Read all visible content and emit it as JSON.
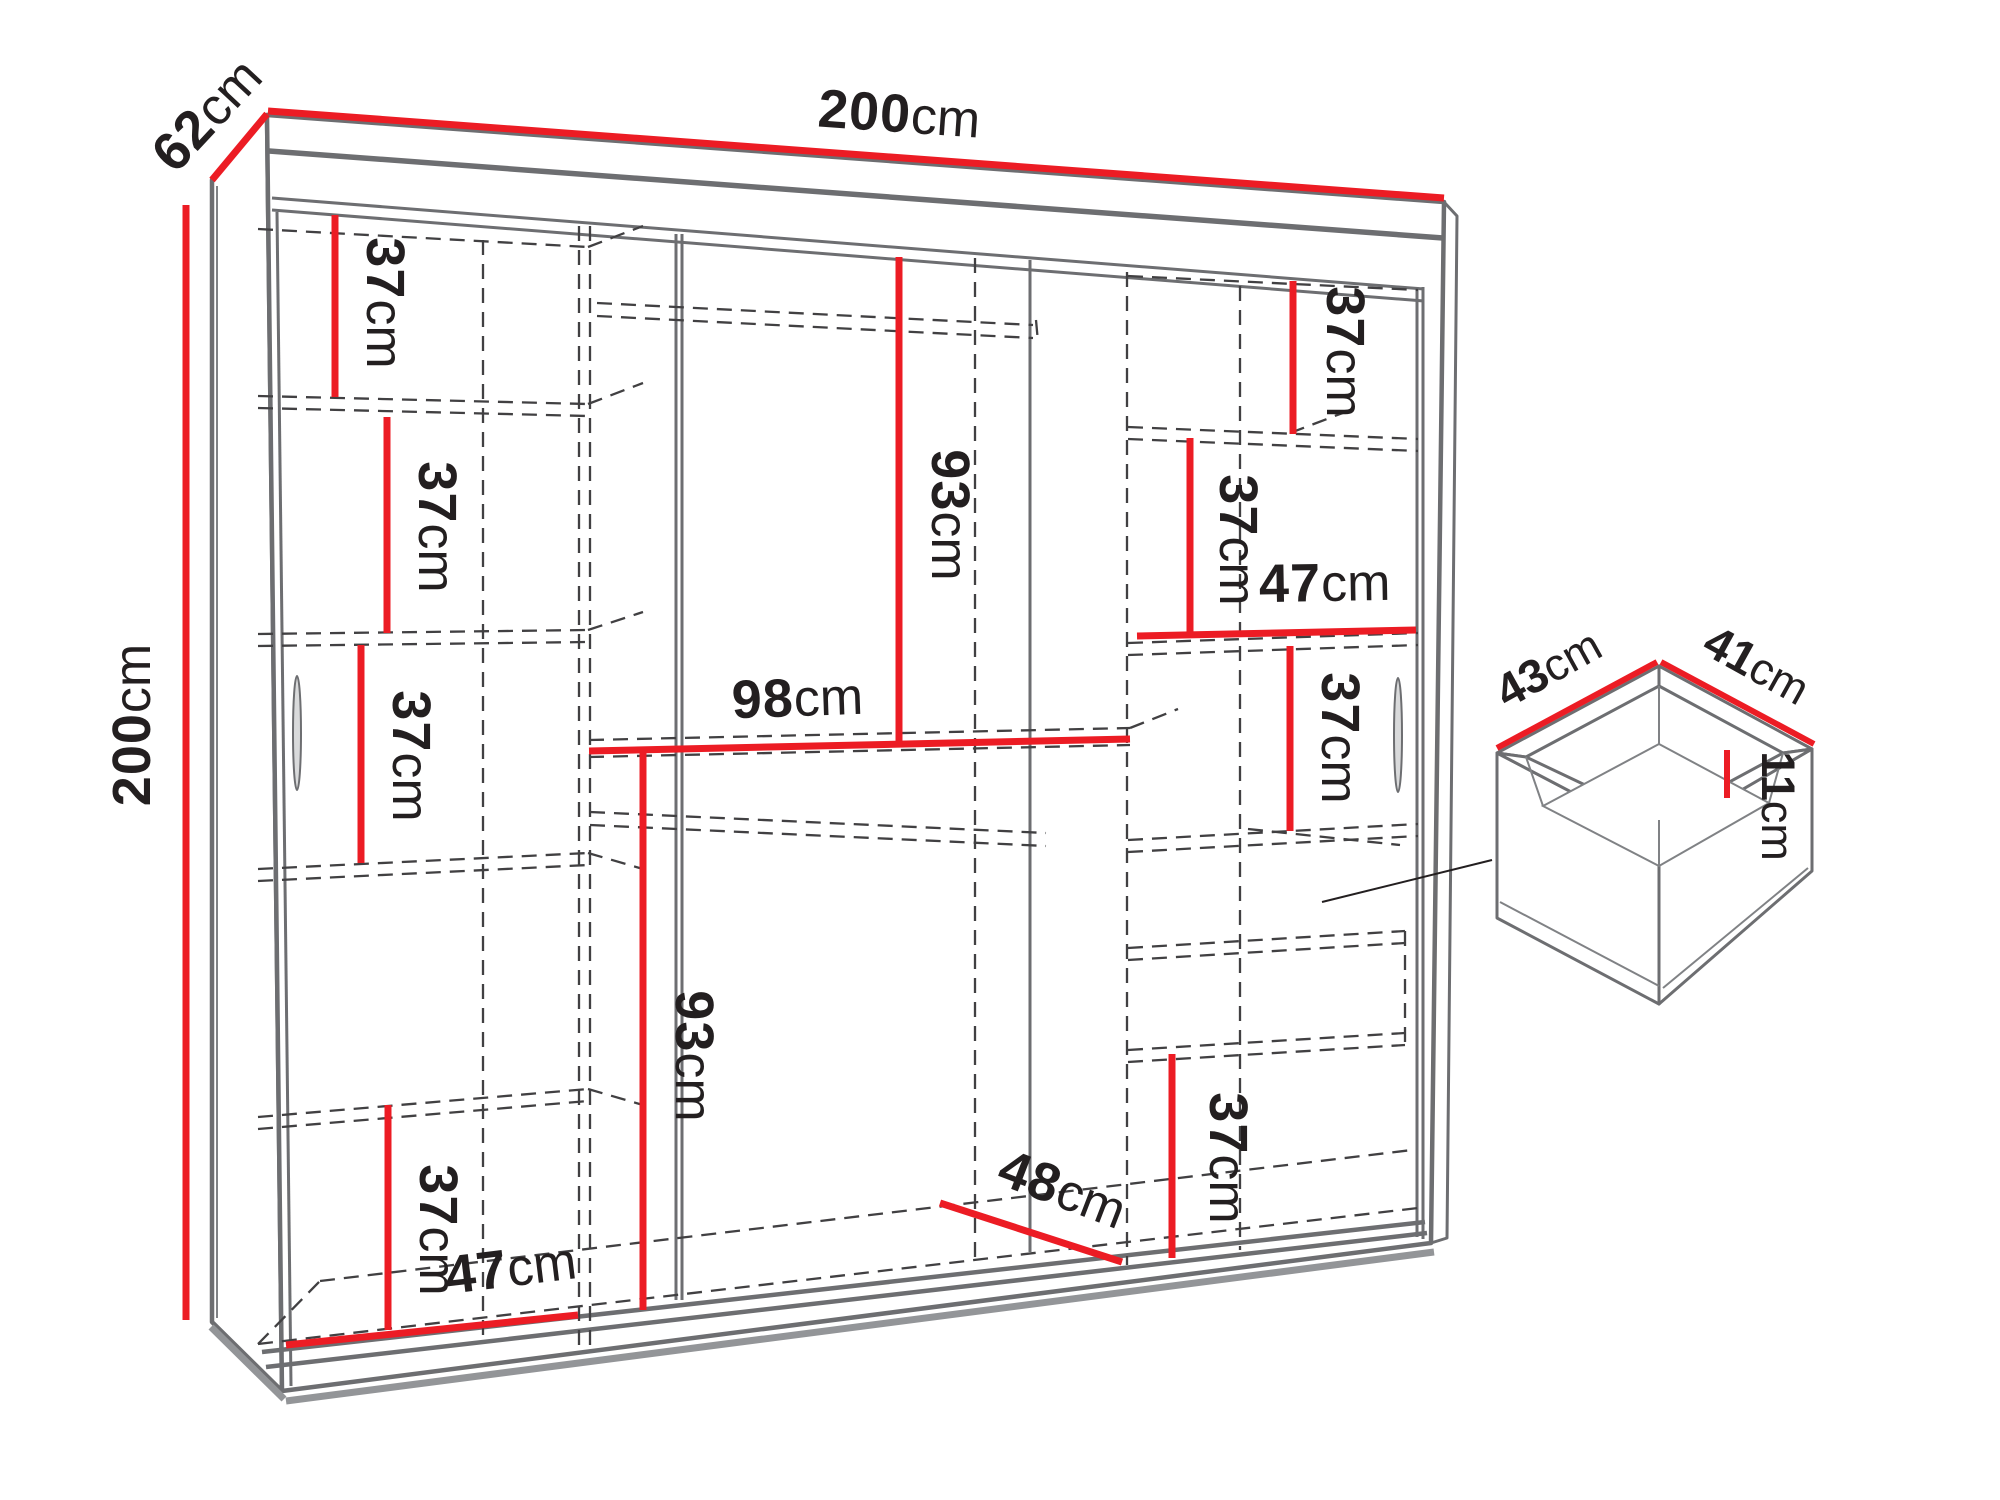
{
  "figure": {
    "type": "furniture-dimension-diagram",
    "subject": "three-door sliding wardrobe with drawer detail",
    "units": "cm"
  },
  "colors": {
    "dimension": "#ec1c24",
    "structure": "#6d6e71",
    "hidden_lines": "#414042",
    "text": "#231f20"
  },
  "wardrobe": {
    "overall": {
      "width": {
        "num": "200",
        "unit": "cm"
      },
      "depth": {
        "num": "62",
        "unit": "cm"
      },
      "height": {
        "num": "200",
        "unit": "cm"
      }
    },
    "left_column": {
      "shelf_gap_1": {
        "num": "37",
        "unit": "cm"
      },
      "shelf_gap_2": {
        "num": "37",
        "unit": "cm"
      },
      "shelf_gap_3": {
        "num": "37",
        "unit": "cm"
      },
      "shelf_gap_4": {
        "num": "37",
        "unit": "cm"
      },
      "bottom_width": {
        "num": "47",
        "unit": "cm"
      }
    },
    "middle_column": {
      "upper_hanging_height": {
        "num": "93",
        "unit": "cm"
      },
      "shelf_width": {
        "num": "98",
        "unit": "cm"
      },
      "lower_hanging_height": {
        "num": "93",
        "unit": "cm"
      },
      "bottom_depth": {
        "num": "48",
        "unit": "cm"
      }
    },
    "right_column": {
      "shelf_gap_1": {
        "num": "37",
        "unit": "cm"
      },
      "shelf_gap_2": {
        "num": "37",
        "unit": "cm"
      },
      "shelf_width": {
        "num": "47",
        "unit": "cm"
      },
      "shelf_gap_3": {
        "num": "37",
        "unit": "cm"
      },
      "shelf_gap_4": {
        "num": "37",
        "unit": "cm"
      }
    }
  },
  "drawer_detail": {
    "width": {
      "num": "43",
      "unit": "cm"
    },
    "depth": {
      "num": "41",
      "unit": "cm"
    },
    "height": {
      "num": "11",
      "unit": "cm"
    }
  }
}
